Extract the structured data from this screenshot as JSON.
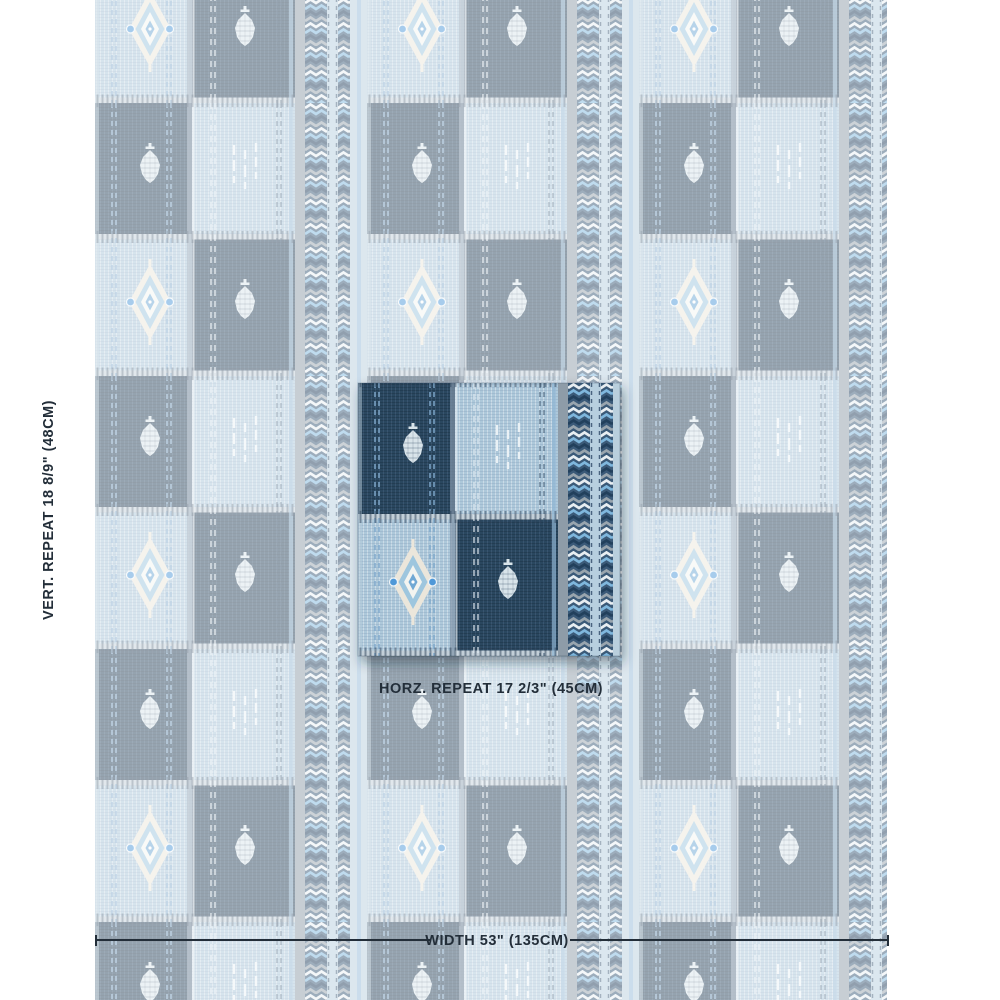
{
  "annotations": {
    "vertical_repeat_label": "VERT. REPEAT 18 8/9\" (48CM)",
    "horizontal_repeat_label": "HORZ. REPEAT 17 2/3\" (45CM)",
    "width_label": "WIDTH 53\" (135CM)"
  },
  "fabric": {
    "style": "patchwork checkerboard stripe with ikat motifs and chevron borders",
    "motifs": [
      "diamond-medallion",
      "teardrop-drop",
      "stitch-dashes",
      "chevron-border-stripe"
    ],
    "palette": {
      "navy": "#2a465f",
      "light_blue": "#adc8da",
      "sky_accent": "#5b9fd8",
      "cream": "#ebe6db",
      "slate_gray": "#8e9ca8",
      "chevron_base": "#3a5a78",
      "motif_white": "#edf3f6",
      "text": "#232e39",
      "background": "#ffffff"
    },
    "background_fade_overlay_opacity": 0.5
  }
}
